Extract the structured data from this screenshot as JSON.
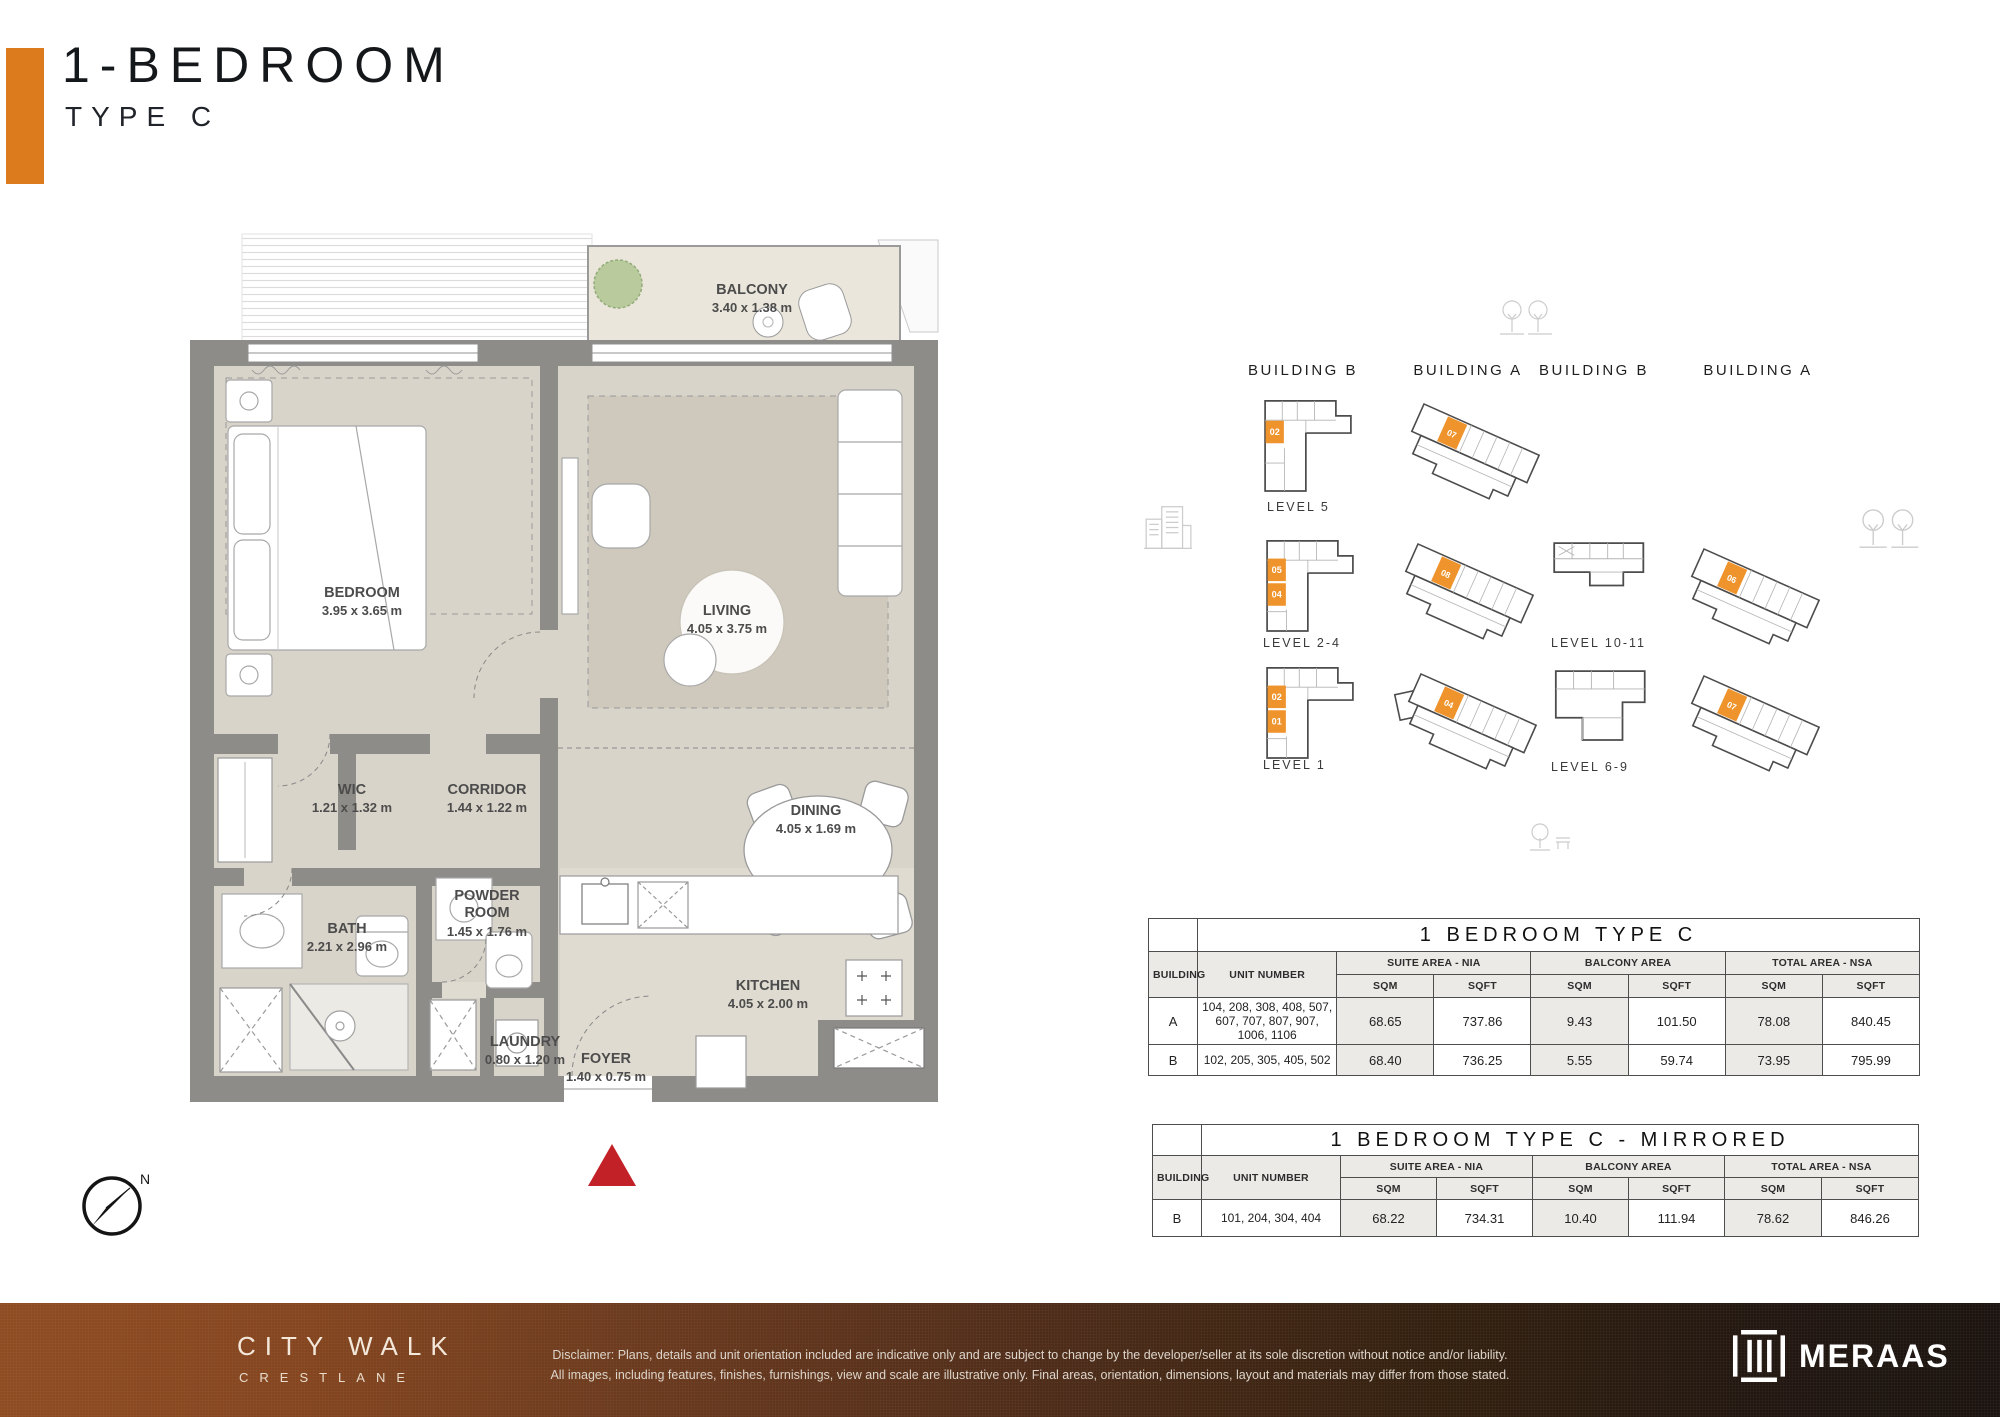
{
  "page": {
    "title": "1-BEDROOM",
    "subtitle": "TYPE C"
  },
  "floorplan": {
    "compass": "N",
    "rooms": [
      {
        "name": "BALCONY",
        "dims": "3.40 x 1.38 m"
      },
      {
        "name": "BEDROOM",
        "dims": "3.95 x 3.65 m"
      },
      {
        "name": "LIVING",
        "dims": "4.05 x 3.75 m"
      },
      {
        "name": "WIC",
        "dims": "1.21 x 1.32 m"
      },
      {
        "name": "CORRIDOR",
        "dims": "1.44 x 1.22 m"
      },
      {
        "name": "DINING",
        "dims": "4.05 x 1.69 m"
      },
      {
        "name": "BATH",
        "dims": "2.21 x 2.96 m"
      },
      {
        "name": "POWDER ROOM",
        "dims": "1.45 x 1.76 m"
      },
      {
        "name": "KITCHEN",
        "dims": "4.05 x 2.00 m"
      },
      {
        "name": "LAUNDRY",
        "dims": "0.80 x 1.20 m"
      },
      {
        "name": "FOYER",
        "dims": "1.40 x 0.75 m"
      }
    ]
  },
  "keyplan": {
    "columns": [
      {
        "label": "BUILDING B"
      },
      {
        "label": "BUILDING A"
      },
      {
        "label": "BUILDING B"
      },
      {
        "label": "BUILDING A"
      }
    ],
    "levels": {
      "l5": "LEVEL 5",
      "l24": "LEVEL 2-4",
      "l1": "LEVEL 1",
      "l1011": "LEVEL 10-11",
      "l69": "LEVEL 6-9"
    },
    "units": {
      "b_l5": [
        "02"
      ],
      "b_l24": [
        "05",
        "04"
      ],
      "b_l1": [
        "02",
        "01"
      ],
      "a_l5": [
        "07"
      ],
      "a_l24": [
        "08"
      ],
      "a_l1": [
        "04"
      ],
      "a_l1011": [
        "06"
      ],
      "a_l69": [
        "07"
      ]
    }
  },
  "tables": [
    {
      "title": "1 BEDROOM TYPE C",
      "building_header": "BUILDING",
      "unit_header": "UNIT NUMBER",
      "groups": [
        {
          "label": "SUITE AREA - NIA"
        },
        {
          "label": "BALCONY AREA"
        },
        {
          "label": "TOTAL AREA - NSA"
        }
      ],
      "sub": [
        "SQM",
        "SQFT",
        "SQM",
        "SQFT",
        "SQM",
        "SQFT"
      ],
      "rows": [
        {
          "building": "A",
          "units": "104, 208, 308, 408, 507,  607, 707, 807, 907, 1006, 1106",
          "values": [
            "68.65",
            "737.86",
            "9.43",
            "101.50",
            "78.08",
            "840.45"
          ]
        },
        {
          "building": "B",
          "units": "102, 205, 305, 405, 502",
          "values": [
            "68.40",
            "736.25",
            "5.55",
            "59.74",
            "73.95",
            "795.99"
          ]
        }
      ]
    },
    {
      "title": "1 BEDROOM TYPE C - MIRRORED",
      "building_header": "BUILDING",
      "unit_header": "UNIT NUMBER",
      "groups": [
        {
          "label": "SUITE AREA - NIA"
        },
        {
          "label": "BALCONY AREA"
        },
        {
          "label": "TOTAL AREA - NSA"
        }
      ],
      "sub": [
        "SQM",
        "SQFT",
        "SQM",
        "SQFT",
        "SQM",
        "SQFT"
      ],
      "rows": [
        {
          "building": "B",
          "units": "101, 204, 304, 404",
          "values": [
            "68.22",
            "734.31",
            "10.40",
            "111.94",
            "78.62",
            "846.26"
          ]
        }
      ]
    }
  ],
  "footer": {
    "brand_line1": "CITY WALK",
    "brand_line2": "CRESTLANE",
    "disclaimer_line1": "Disclaimer: Plans, details and unit orientation included are indicative only and are subject to change by the developer/seller at its sole discretion without notice and/or liability.",
    "disclaimer_line2": "All images, including features, finishes, furnishings, view and scale are illustrative only. Final areas, orientation, dimensions, layout and materials may differ from those stated.",
    "logo_text": "MERAAS"
  },
  "colors": {
    "accent_orange": "#DC7A1E",
    "unit_orange": "#EF942D",
    "entrance_red": "#C22127"
  }
}
